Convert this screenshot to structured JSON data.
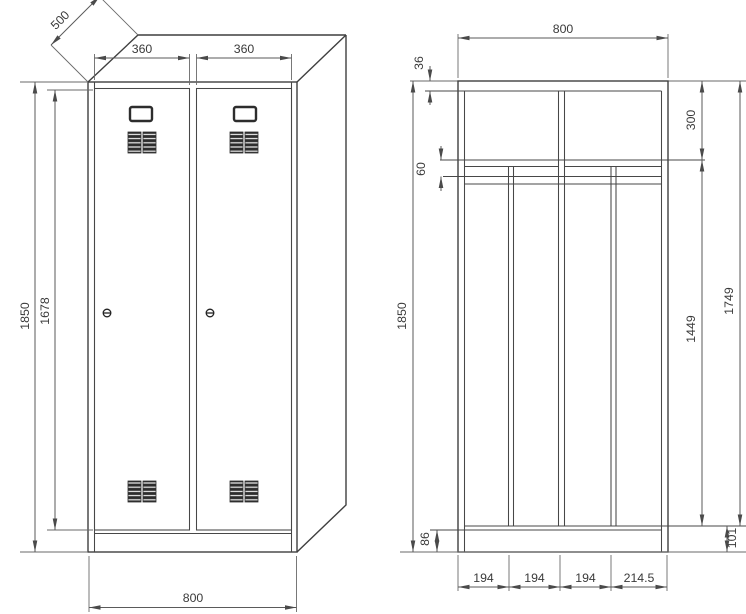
{
  "front_view": {
    "depth": "500",
    "door_width_left": "360",
    "door_width_right": "360",
    "overall_height": "1850",
    "door_height": "1678",
    "overall_width": "800"
  },
  "section_view": {
    "overall_width": "800",
    "top_panel_offset": "36",
    "top_compartment_height": "300",
    "shelf_assembly_height": "60",
    "overall_height": "1850",
    "hanging_space_height": "1449",
    "interior_height": "1749",
    "plinth_height": "86",
    "floor_height": "101",
    "compartment_widths": [
      "194",
      "194",
      "194",
      "214.5"
    ]
  }
}
